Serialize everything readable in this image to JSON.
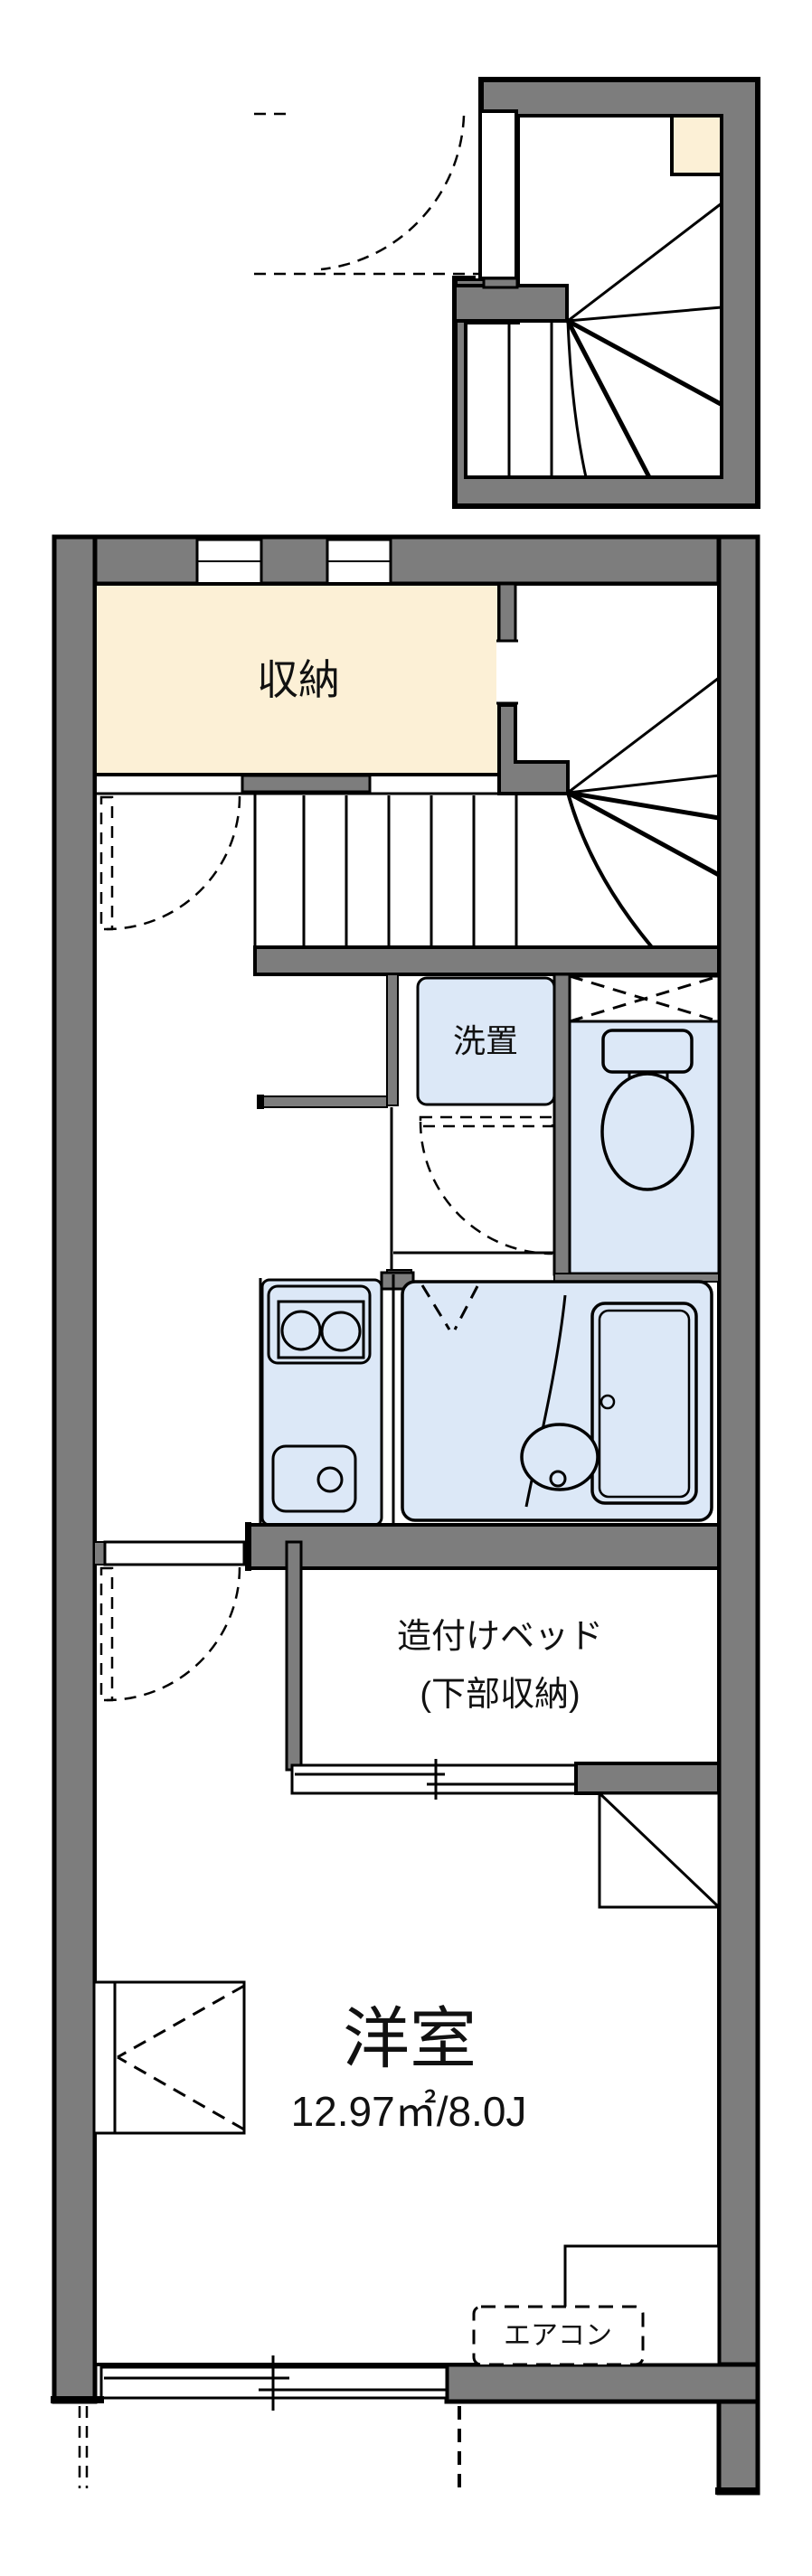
{
  "document": {
    "type": "apartment-floor-plan"
  },
  "colors": {
    "wall_fill": "#7d7d7d",
    "outline": "#000000",
    "wet_area_fill": "#dce8f7",
    "storage_fill": "#fcf0d6",
    "background": "#ffffff"
  },
  "labels": {
    "storage": "収納",
    "washer": "洗置",
    "built_in_bed_line1": "造付けベッド",
    "built_in_bed_line2": "(下部収納)",
    "western_room": "洋室",
    "western_room_size": "12.97㎡/8.0J",
    "air_conditioner": "エアコン"
  }
}
